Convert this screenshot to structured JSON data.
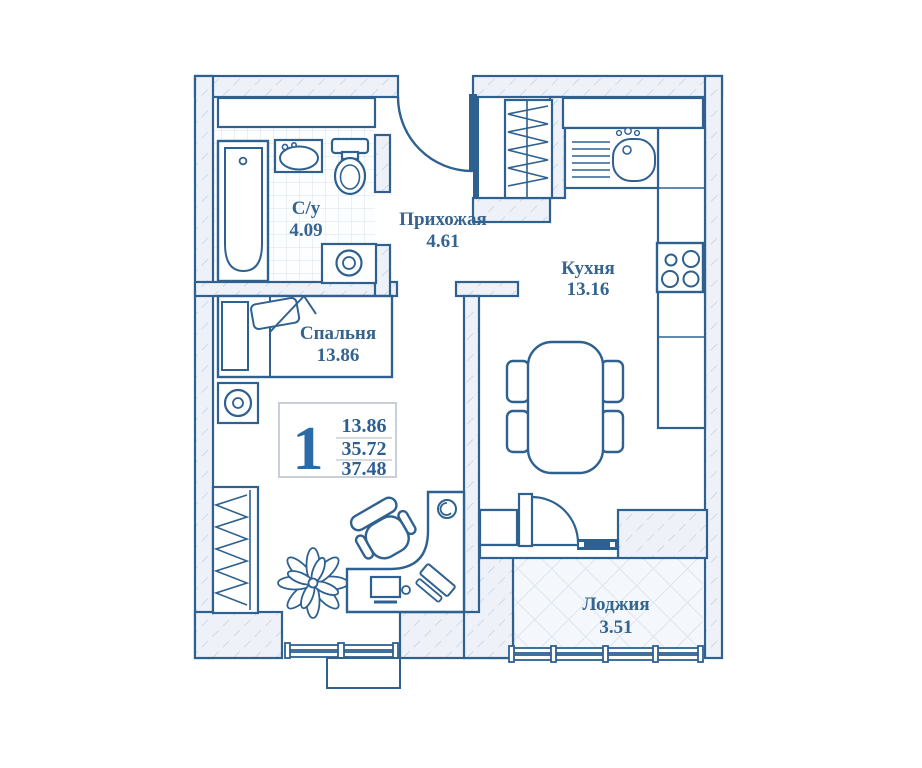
{
  "palette": {
    "line": "#2e6190",
    "text": "#35648e",
    "accent": "#2c6ba7",
    "hatch_line": "#b7c7d9",
    "hatch_bg": "#eef2f8",
    "tile_line": "#d6e1ed",
    "plank_line": "#c5d3e2",
    "legend_border": "#c9cfd6"
  },
  "legend": {
    "rooms_count": "1",
    "living_area": "13.86",
    "area_no_loggia": "35.72",
    "total_area": "37.48"
  },
  "rooms": {
    "bathroom": {
      "name": "С/у",
      "area": "4.09"
    },
    "hallway": {
      "name": "Прихожая",
      "area": "4.61"
    },
    "kitchen": {
      "name": "Кухня",
      "area": "13.16"
    },
    "bedroom": {
      "name": "Спальня",
      "area": "13.86"
    },
    "loggia": {
      "name": "Лоджия",
      "area": "3.51"
    }
  }
}
